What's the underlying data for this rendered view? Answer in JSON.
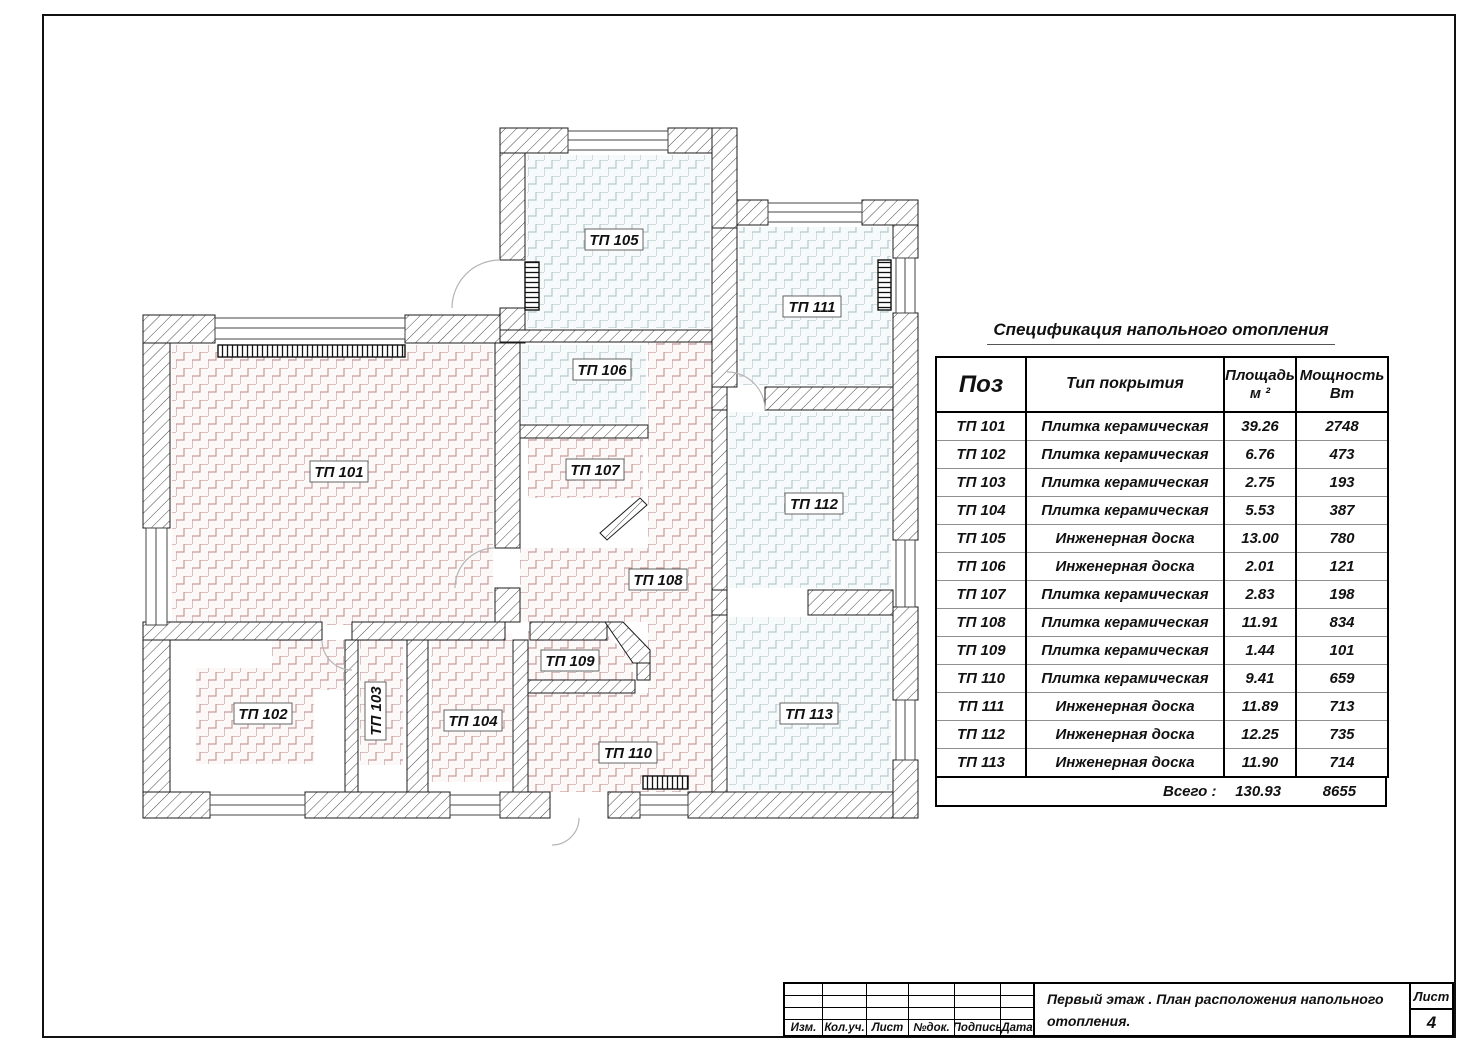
{
  "spec": {
    "title": "Спецификация напольного отопления",
    "headers": {
      "pos": "Поз",
      "type": "Тип покрытия",
      "area_line1": "Площадь",
      "area_line2": "м ²",
      "power_line1": "Мощность",
      "power_line2": "Вт"
    },
    "rows": [
      {
        "pos": "ТП 101",
        "type": "Плитка керамическая",
        "area": "39.26",
        "power": "2748"
      },
      {
        "pos": "ТП 102",
        "type": "Плитка керамическая",
        "area": "6.76",
        "power": "473"
      },
      {
        "pos": "ТП 103",
        "type": "Плитка керамическая",
        "area": "2.75",
        "power": "193"
      },
      {
        "pos": "ТП 104",
        "type": "Плитка керамическая",
        "area": "5.53",
        "power": "387"
      },
      {
        "pos": "ТП 105",
        "type": "Инженерная доска",
        "area": "13.00",
        "power": "780"
      },
      {
        "pos": "ТП 106",
        "type": "Инженерная доска",
        "area": "2.01",
        "power": "121"
      },
      {
        "pos": "ТП 107",
        "type": "Плитка керамическая",
        "area": "2.83",
        "power": "198"
      },
      {
        "pos": "ТП 108",
        "type": "Плитка керамическая",
        "area": "11.91",
        "power": "834"
      },
      {
        "pos": "ТП 109",
        "type": "Плитка керамическая",
        "area": "1.44",
        "power": "101"
      },
      {
        "pos": "ТП 110",
        "type": "Плитка керамическая",
        "area": "9.41",
        "power": "659"
      },
      {
        "pos": "ТП 111",
        "type": "Инженерная доска",
        "area": "11.89",
        "power": "713"
      },
      {
        "pos": "ТП 112",
        "type": "Инженерная доска",
        "area": "12.25",
        "power": "735"
      },
      {
        "pos": "ТП 113",
        "type": "Инженерная доска",
        "area": "11.90",
        "power": "714"
      }
    ],
    "total_label": "Всего :",
    "total_area": "130.93",
    "total_power": "8655"
  },
  "plan": {
    "rooms": [
      {
        "label": "ТП 101"
      },
      {
        "label": "ТП 102"
      },
      {
        "label": "ТП 103"
      },
      {
        "label": "ТП 104"
      },
      {
        "label": "ТП 105"
      },
      {
        "label": "ТП 106"
      },
      {
        "label": "ТП 107"
      },
      {
        "label": "ТП 108"
      },
      {
        "label": "ТП 109"
      },
      {
        "label": "ТП 110"
      },
      {
        "label": "ТП 111"
      },
      {
        "label": "ТП 112"
      },
      {
        "label": "ТП 113"
      }
    ]
  },
  "title_block": {
    "columns": [
      "Изм.",
      "Кол.уч.",
      "Лист",
      "№док.",
      "Подпись",
      "Дата"
    ],
    "doc_title_line1": "Первый этаж . План расположения напольного",
    "doc_title_line2": "отопления.",
    "sheet_label": "Лист",
    "sheet_number": "4"
  },
  "colors": {
    "tile_zone_line": "#c79c9c",
    "wood_zone_line": "#b5c8ce",
    "wall_hatch": "#4a4a4a"
  }
}
